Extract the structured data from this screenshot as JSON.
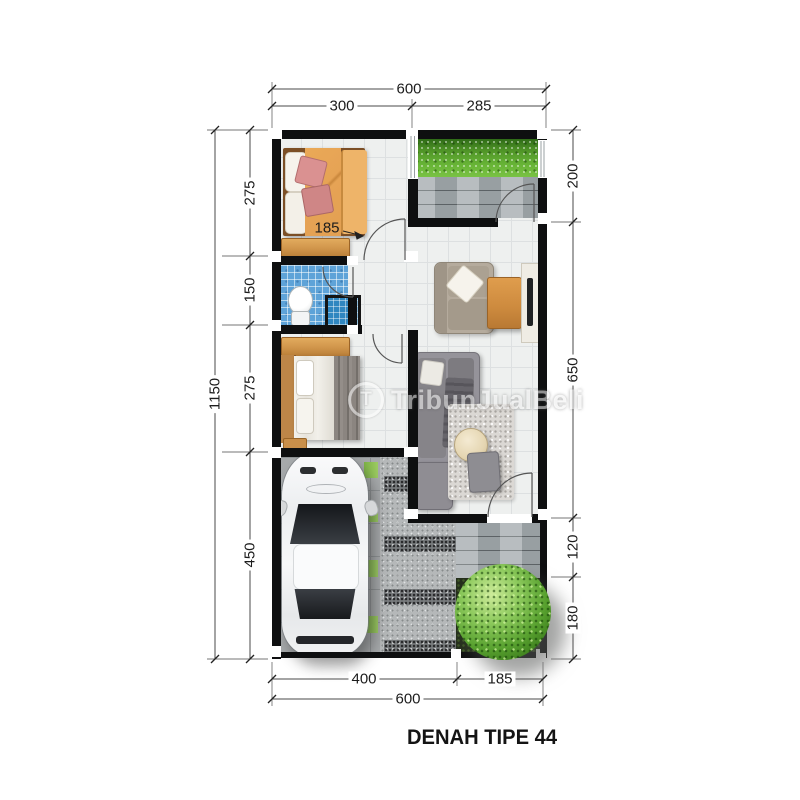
{
  "title": "DENAH TIPE 44",
  "watermark": {
    "logo_letter": "T",
    "text": "TribunJualBeli"
  },
  "dims": {
    "top": {
      "overall": "600",
      "segments": [
        "300",
        "285"
      ]
    },
    "left": {
      "overall": "1150",
      "segments": [
        "275",
        "150",
        "275",
        "450"
      ]
    },
    "right": {
      "segments": [
        "200",
        "650",
        "120",
        "180"
      ]
    },
    "bottom": {
      "overall": "600",
      "segments": [
        "400",
        "185"
      ]
    },
    "interior": {
      "bed_width": "185"
    }
  },
  "colors": {
    "wall": "#0e0f10",
    "grass_green": "#66b335",
    "bathroom_tile_blue": "#5ea3d8",
    "wood_orange": "#d8984e",
    "paving_gray": "#a6adb0",
    "tree_green": "#57a02e",
    "dimension_text": "#1c1c1c"
  }
}
